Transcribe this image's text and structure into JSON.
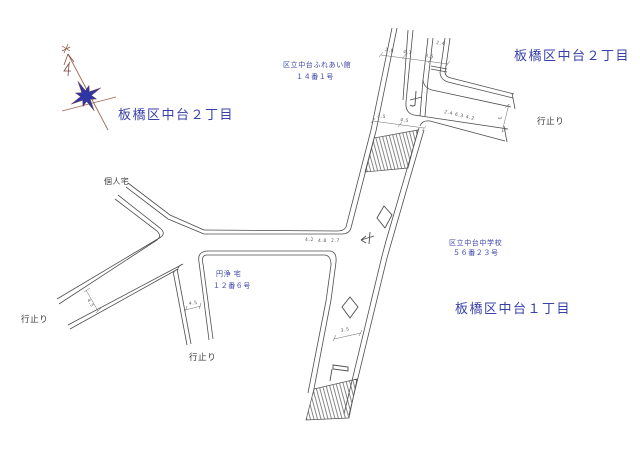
{
  "districts": {
    "nw": "板橋区中台２丁目",
    "ne": "板橋区中台２丁目",
    "se": "板橋区中台１丁目"
  },
  "places": {
    "hall_name": "区立中台ふれあい館",
    "hall_no": "１４番１号",
    "school_name": "区立中台中学校",
    "school_no": "５６番２３号",
    "private_house": "個人宅",
    "enjo_house": "円浄 宅",
    "enjo_no": "１２番６号"
  },
  "dead_ends": {
    "ne": "行止り",
    "sw": "行止り",
    "s": "行止り"
  },
  "dims": {
    "top1": "2.0",
    "top2": "4.1",
    "top3": "3.5",
    "top4": "2.4",
    "mid1": "3.5",
    "mid2": "4.5",
    "west1": "4.2",
    "west2": "4.0",
    "west3": "2.7",
    "east_chain": "2.4 6.3 4.2",
    "east_gap": "3",
    "sw": "4.5",
    "south": "4.5",
    "lower": "3.5"
  },
  "colors": {
    "label_blue": "#3841a8",
    "line_ink": "#4d4d4d",
    "dim_gray": "#666666",
    "compass_blue": "#2e36a6",
    "compass_brown": "#9b6a58"
  }
}
